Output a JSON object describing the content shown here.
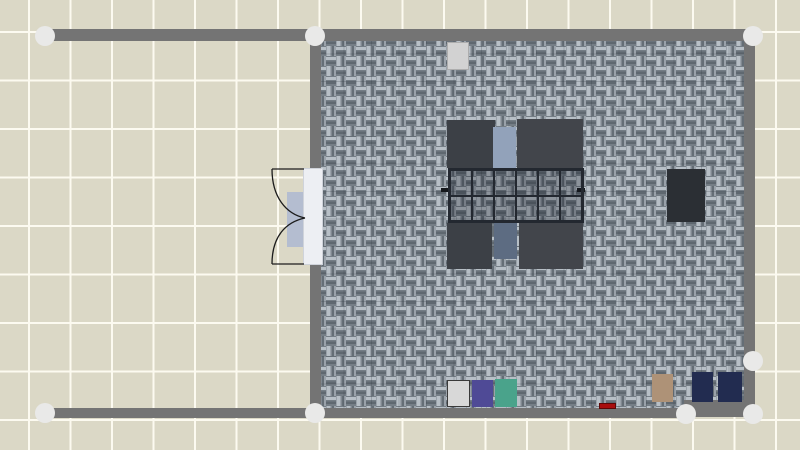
{
  "app": {
    "view": "floor-plan-canvas"
  },
  "palette": {
    "wall": "#747474",
    "joint": "#e9e9e8",
    "outside_tile": "#dbd8c6",
    "grout": "#fcfaf0",
    "carpet_base": "#8a939b",
    "carpet_light": "#b7bfc6",
    "carpet_mid": "#9aa2aa",
    "carpet_dark": "#656e76",
    "carpet_deep": "#757e86",
    "carpet_grid_line": "rgba(45,53,63,0.22)"
  },
  "plan": {
    "outside": {
      "tile_color": "#dbd8c6",
      "grout_color": "#fcfaf0",
      "tile_w": 41.5,
      "tile_h": 48.5,
      "offset_x": 28,
      "offset_y": 31
    },
    "room_floor": {
      "x": 316,
      "y": 36,
      "w": 433,
      "h": 376,
      "carpet_tile": 27.5
    },
    "walls": [
      {
        "name": "top",
        "x": 45,
        "y": 29,
        "w": 710,
        "h": 12
      },
      {
        "name": "left",
        "x": 310,
        "y": 29,
        "w": 11,
        "h": 390
      },
      {
        "name": "right",
        "x": 744,
        "y": 29,
        "w": 11,
        "h": 390
      },
      {
        "name": "bottom-main",
        "x": 45,
        "y": 408,
        "w": 643,
        "h": 10
      },
      {
        "name": "bottom-right",
        "x": 684,
        "y": 400,
        "w": 71,
        "h": 17
      }
    ],
    "joints": [
      {
        "name": "joint-top-far-left",
        "cx": 45,
        "cy": 36
      },
      {
        "name": "joint-top-left-corner",
        "cx": 315,
        "cy": 36
      },
      {
        "name": "joint-top-right-corner",
        "cx": 753,
        "cy": 36
      },
      {
        "name": "joint-right-mid",
        "cx": 753,
        "cy": 361
      },
      {
        "name": "joint-bottom-far-left",
        "cx": 45,
        "cy": 413
      },
      {
        "name": "joint-bottom-left-corner",
        "cx": 315,
        "cy": 413
      },
      {
        "name": "joint-bottom-mid",
        "cx": 686,
        "cy": 414
      },
      {
        "name": "joint-bottom-right-corner",
        "cx": 753,
        "cy": 414
      }
    ],
    "furniture": [
      {
        "name": "cabinet-top-wall",
        "x": 447,
        "y": 42,
        "w": 22,
        "h": 28,
        "color": "#d2d2d2",
        "border": "#adadad"
      },
      {
        "name": "table-top-left",
        "x": 447,
        "y": 120,
        "w": 48,
        "h": 48,
        "color": "#3c4046"
      },
      {
        "name": "chair-top",
        "x": 493,
        "y": 127,
        "w": 23,
        "h": 42,
        "color": "#92a2ba"
      },
      {
        "name": "table-top-right",
        "x": 517,
        "y": 119,
        "w": 66,
        "h": 49,
        "color": "#42454b"
      },
      {
        "name": "table-handle-left",
        "x": 441,
        "y": 188,
        "w": 8,
        "h": 4,
        "color": "#15181c"
      },
      {
        "name": "table-handle-right",
        "x": 577,
        "y": 188,
        "w": 8,
        "h": 4,
        "color": "#15181c"
      },
      {
        "name": "table-bottom-left",
        "x": 447,
        "y": 223,
        "w": 45,
        "h": 46,
        "color": "#3c4046"
      },
      {
        "name": "chair-bottom",
        "x": 494,
        "y": 223,
        "w": 23,
        "h": 36,
        "color": "#5d6c82"
      },
      {
        "name": "table-bottom-right",
        "x": 519,
        "y": 223,
        "w": 64,
        "h": 46,
        "color": "#42454b"
      },
      {
        "name": "cabinet-right-wall",
        "x": 667,
        "y": 169,
        "w": 38,
        "h": 53,
        "color": "#2b2f34"
      },
      {
        "name": "box-white",
        "x": 447,
        "y": 380,
        "w": 23,
        "h": 27,
        "color": "#d8d8d8",
        "border": "#3a3a3a"
      },
      {
        "name": "box-purple",
        "x": 472,
        "y": 380,
        "w": 21,
        "h": 27,
        "color": "#4f4a96"
      },
      {
        "name": "box-teal",
        "x": 495,
        "y": 379,
        "w": 22,
        "h": 28,
        "color": "#4aa38b"
      },
      {
        "name": "doormat-red",
        "x": 599,
        "y": 403,
        "w": 17,
        "h": 6,
        "color": "#a80d0d",
        "border": "#5d0606"
      },
      {
        "name": "box-tan",
        "x": 652,
        "y": 374,
        "w": 21,
        "h": 28,
        "color": "#ae9277"
      },
      {
        "name": "box-navy-1",
        "x": 692,
        "y": 372,
        "w": 21,
        "h": 30,
        "color": "#222c50"
      },
      {
        "name": "box-navy-2",
        "x": 718,
        "y": 372,
        "w": 24,
        "h": 30,
        "color": "#222c50"
      }
    ],
    "grid_table": {
      "x": 448,
      "y": 168,
      "w": 136,
      "h": 55,
      "cols": 6,
      "rows": 2,
      "frame": "#232830",
      "cell_tint": "rgba(18,24,34,0.26)"
    },
    "door": {
      "panel": {
        "x": 303,
        "y": 168,
        "w": 20,
        "h": 97,
        "color": "#edeff3",
        "border": "#cfd3da"
      },
      "mat": {
        "x": 287,
        "y": 192,
        "w": 21,
        "h": 55,
        "color": "#b4bdd0"
      },
      "swing_color": "#1c1c1c"
    }
  }
}
